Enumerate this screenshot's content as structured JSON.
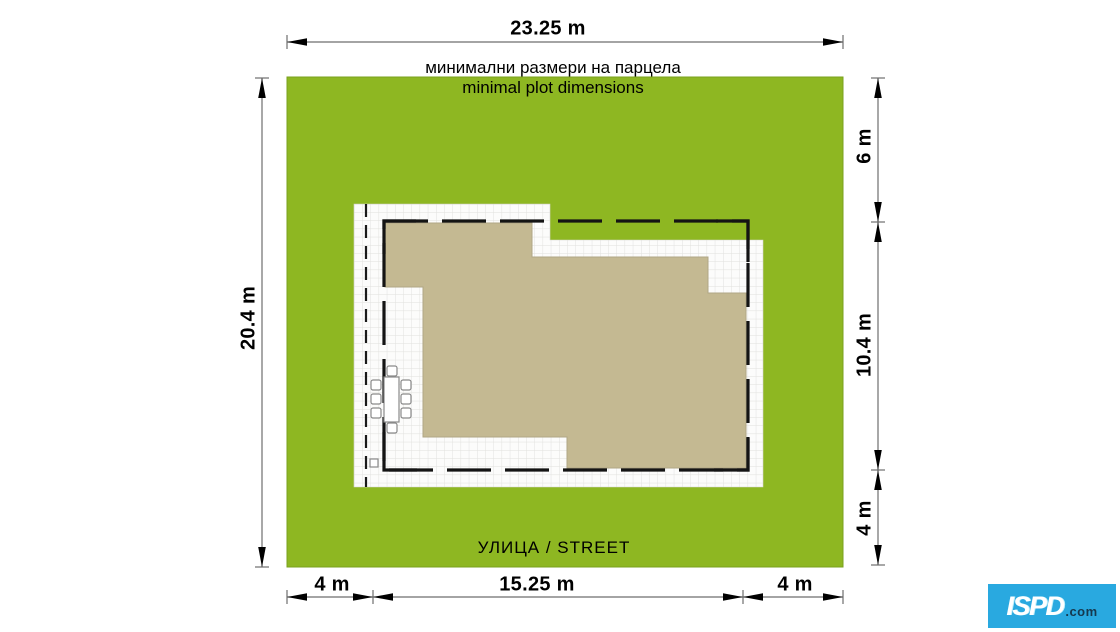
{
  "titles": {
    "bulgarian": "минимални размери на парцела",
    "english": "minimal plot dimensions"
  },
  "street_label": "УЛИЦА / STREET",
  "dimensions": {
    "top_width": "23.25 m",
    "left_height": "20.4 m",
    "right_top": "6 m",
    "right_middle": "10.4 m",
    "right_bottom": "4 m",
    "bottom_left": "4 m",
    "bottom_center": "15.25 m",
    "bottom_right": "4 m"
  },
  "logo": {
    "brand": "ISPD",
    "suffix": ".com"
  },
  "colors": {
    "plot_green": "#8eb722",
    "house_beige": "#c4b992",
    "grid_line": "#e0e0dc",
    "dashed_boundary": "#141414",
    "dimension_line": "#6e6e6e",
    "logo_blue": "#29a9e0",
    "logo_text_dark": "#15394f"
  }
}
